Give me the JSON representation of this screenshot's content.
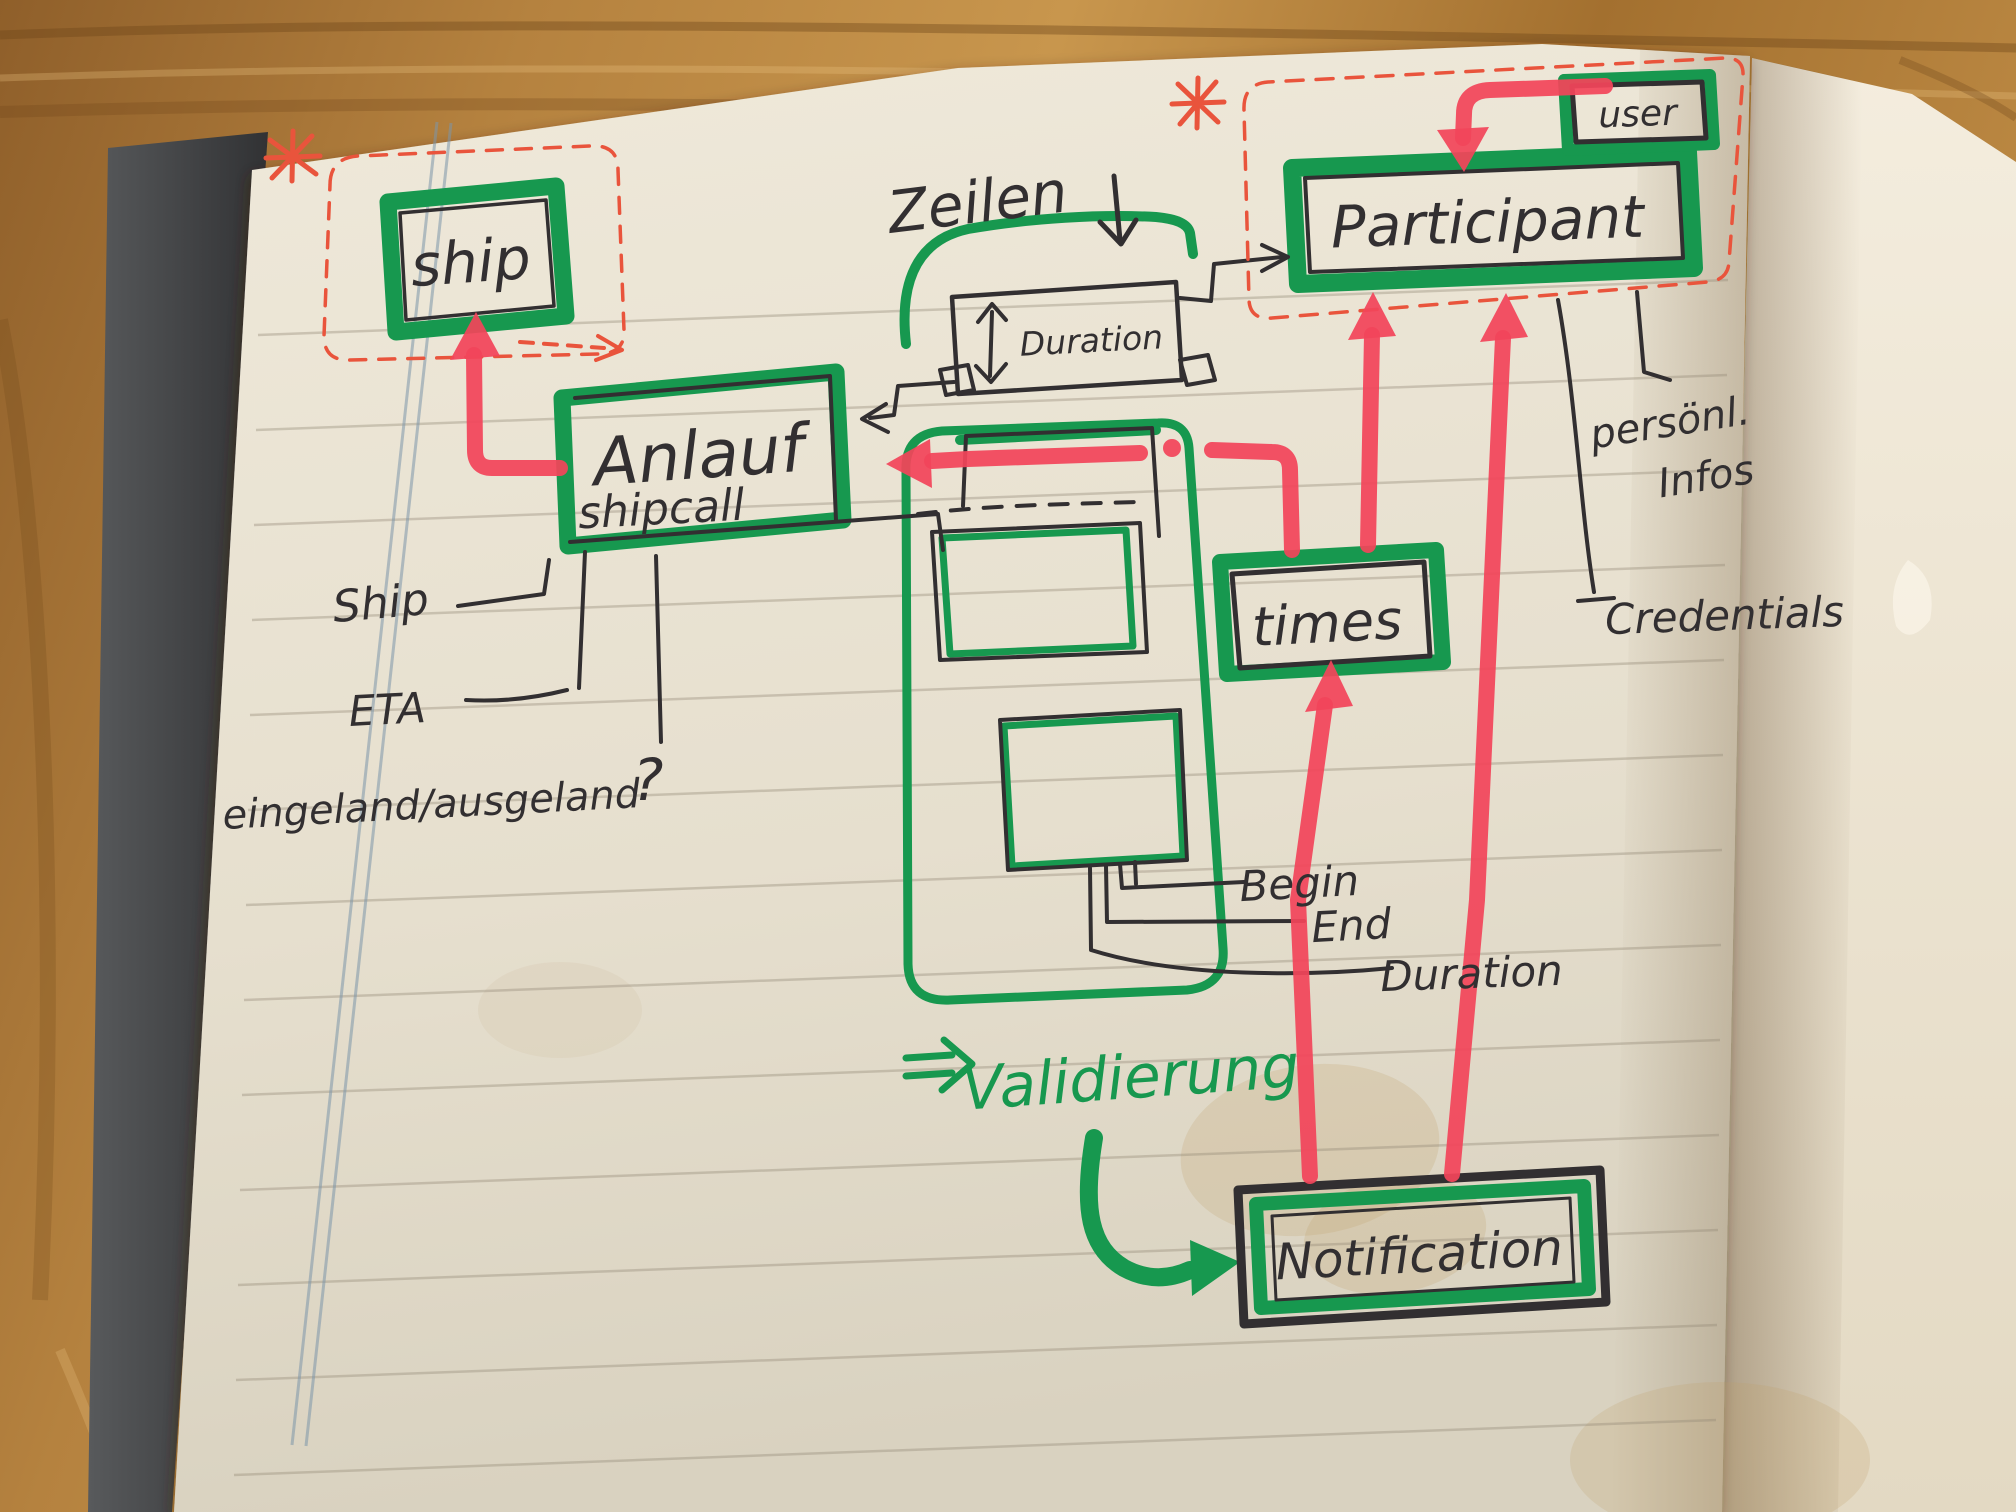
{
  "sketch": {
    "entities": {
      "ship_box": "ship",
      "anlauf_title": "Anlauf",
      "anlauf_subtitle": "shipcall",
      "participant_box": "Participant",
      "user_box": "user",
      "duration_inner_box": "Duration",
      "times_box": "times",
      "notification_box": "Notification"
    },
    "annotations": {
      "zeilen": "Zeilen",
      "ship_attr": "Ship",
      "eta_attr": "ETA",
      "in_out_attr": "eingeland/ausgeland",
      "question_mark": "?",
      "begin_attr": "Begin",
      "end_attr": "End",
      "duration_attr": "Duration",
      "personal_line1": "persönl.",
      "personal_line2": "Infos",
      "credentials_attr": "Credentials",
      "validierung_note": "Validierung",
      "required_asterisk": "*"
    },
    "colors": {
      "marker_green": "#17984f",
      "marker_red": "#f2455a",
      "pen_black": "#322f31",
      "pen_red_orange": "#e9543c",
      "paper": "#ebe5d6",
      "wood": "#b5823f",
      "margin_line_blue": "#7b95a9"
    }
  }
}
